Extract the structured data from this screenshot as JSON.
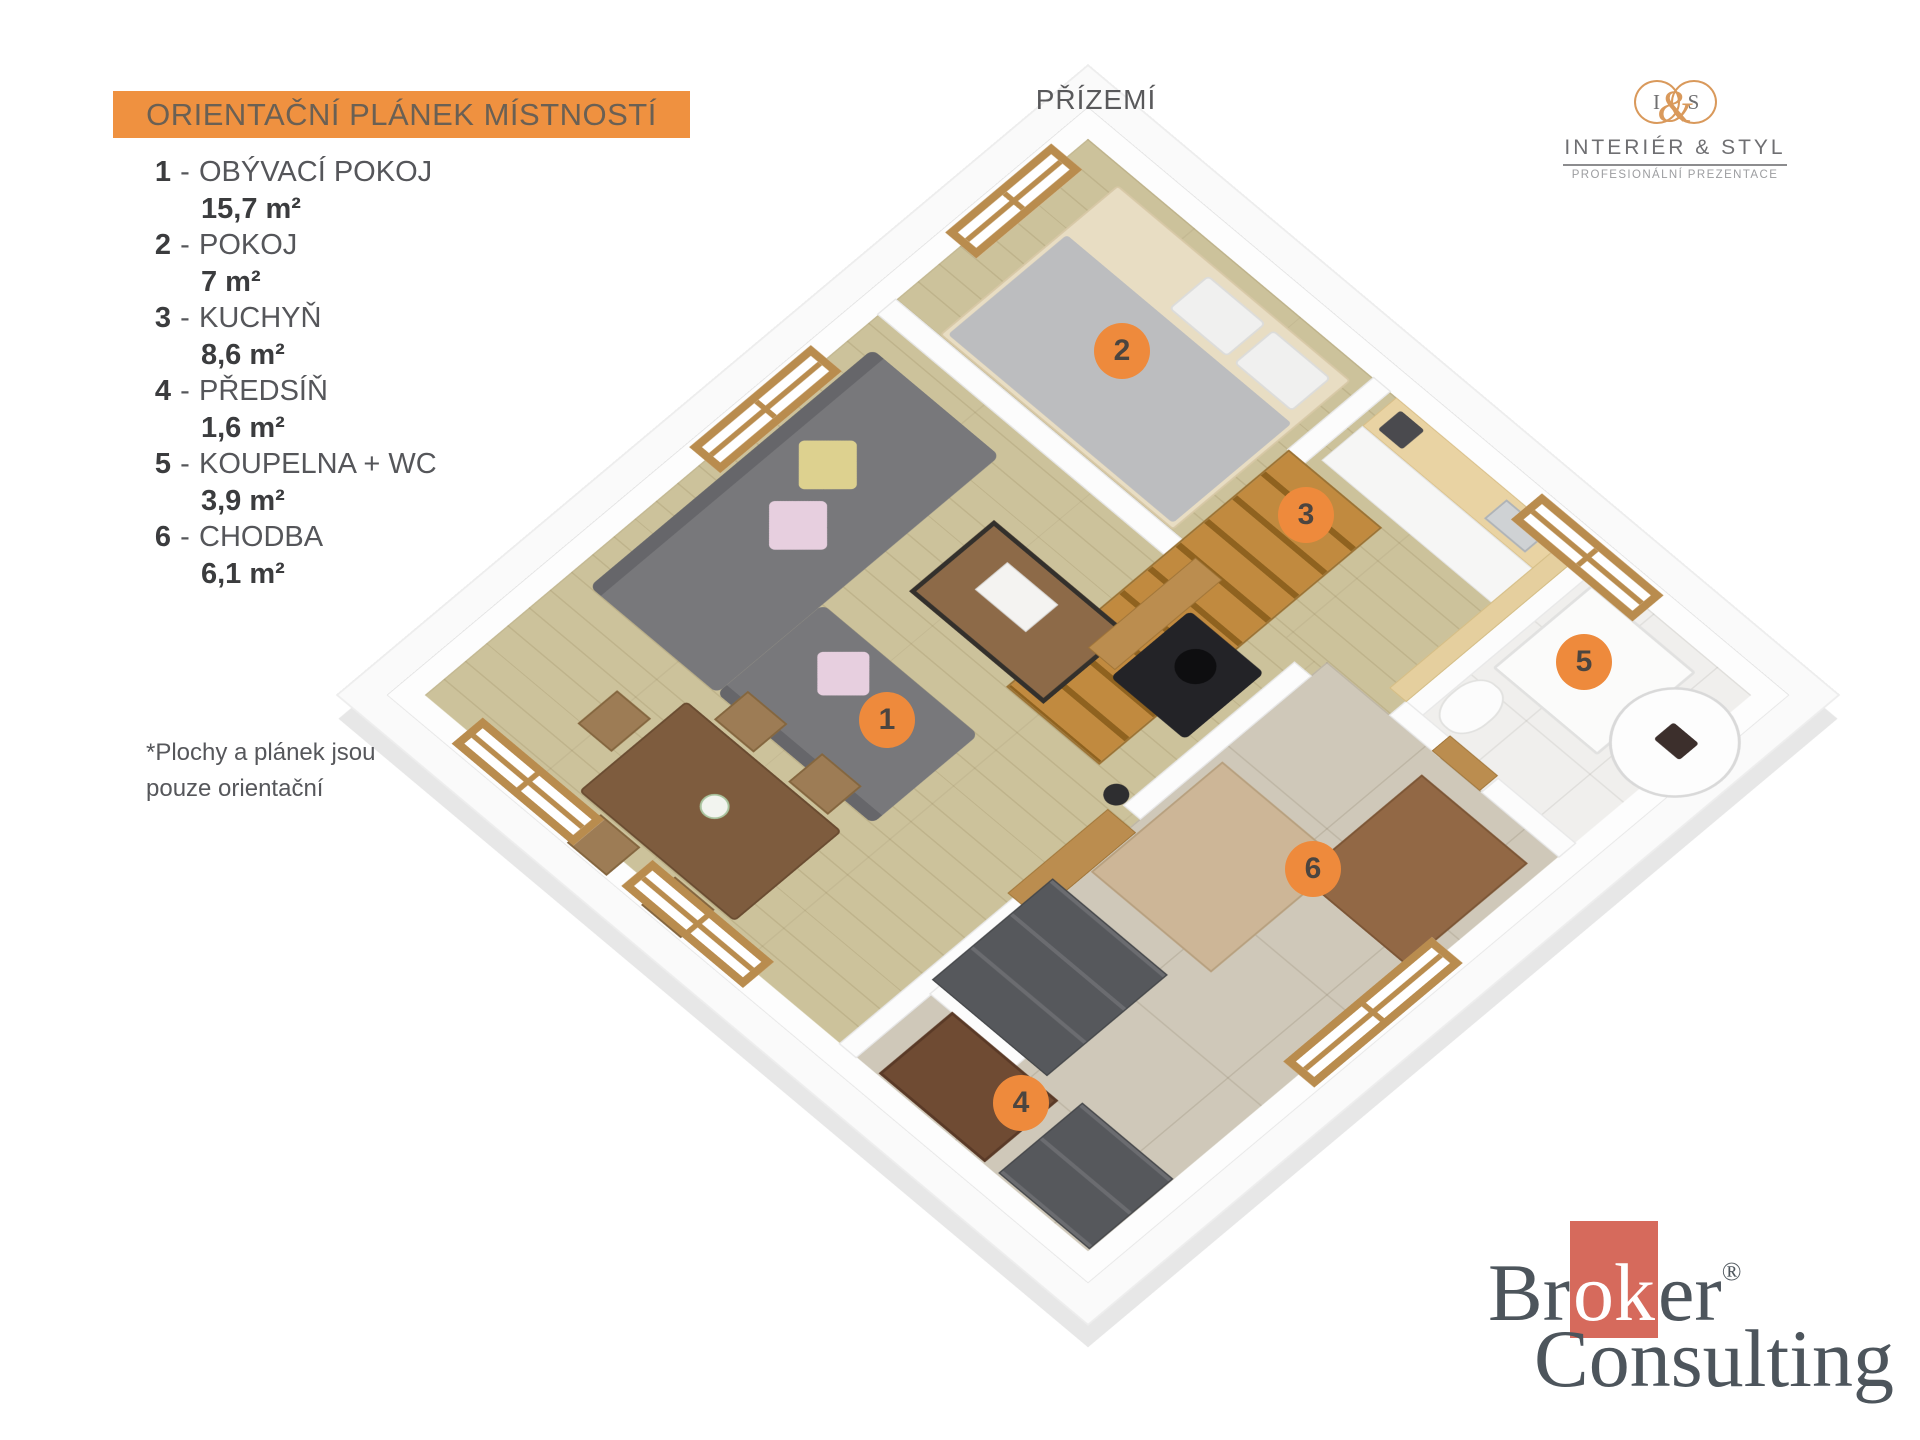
{
  "legend": {
    "title": "ORIENTAČNÍ PLÁNEK MÍSTNOSTÍ",
    "dash": "-",
    "items": [
      {
        "number": "1",
        "name": "OBÝVACÍ POKOJ",
        "area": "15,7 m²"
      },
      {
        "number": "2",
        "name": "POKOJ",
        "area": "7 m²"
      },
      {
        "number": "3",
        "name": "KUCHYŇ",
        "area": "8,6 m²"
      },
      {
        "number": "4",
        "name": "PŘEDSÍŇ",
        "area": "1,6 m²"
      },
      {
        "number": "5",
        "name": "KOUPELNA + WC",
        "area": "3,9 m²"
      },
      {
        "number": "6",
        "name": "CHODBA",
        "area": "6,1 m²"
      }
    ],
    "footnote_line1": "*Plochy  a plánek jsou",
    "footnote_line2": "pouze orientační"
  },
  "floor_label": "PŘÍZEMÍ",
  "interier_styl_logo": {
    "monogram_left": "I",
    "monogram_amp": "&",
    "monogram_right": "S",
    "name": "INTERIÉR & STYL",
    "tagline": "PROFESIONÁLNÍ PREZENTACE"
  },
  "broker_logo": {
    "part1": "Br",
    "highlight": "ok",
    "part2": "er",
    "registered": "®",
    "line2": "Consulting"
  },
  "plan": {
    "markers": [
      {
        "label": "1",
        "x": 887,
        "y": 720
      },
      {
        "label": "2",
        "x": 1122,
        "y": 351
      },
      {
        "label": "3",
        "x": 1306,
        "y": 515
      },
      {
        "label": "4",
        "x": 1021,
        "y": 1103
      },
      {
        "label": "5",
        "x": 1584,
        "y": 662
      },
      {
        "label": "6",
        "x": 1313,
        "y": 869
      }
    ]
  },
  "colors": {
    "accent_orange": "#EF9140",
    "marker_orange": "#EE8A3C",
    "broker_red": "#D66A5C",
    "logo_orange": "#D9995B",
    "legend_text": "#55565A",
    "wood_floor": "#CCC29B",
    "tile_floor": "#CFC8B9"
  }
}
